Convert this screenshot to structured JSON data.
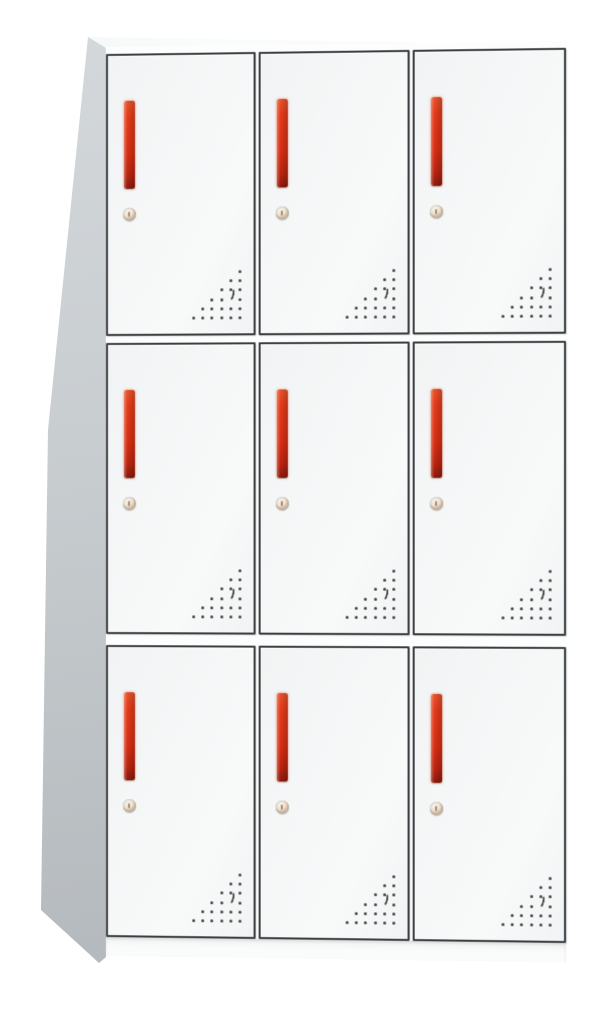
{
  "scene": {
    "description": "Product photo of a white nine-door steel locker cabinet, viewed from the front-left, with red vertical recessed handles, round cam locks and triangular ventilation-hole patterns on each door",
    "background": "#ffffff"
  },
  "cabinet": {
    "type": "nine-door-locker",
    "grid": {
      "rows": 3,
      "cols": 3,
      "door_count": 9
    },
    "doors": [
      {
        "id": "door-1",
        "row": 1,
        "col": 1
      },
      {
        "id": "door-2",
        "row": 1,
        "col": 2
      },
      {
        "id": "door-3",
        "row": 1,
        "col": 3
      },
      {
        "id": "door-4",
        "row": 2,
        "col": 1
      },
      {
        "id": "door-5",
        "row": 2,
        "col": 2
      },
      {
        "id": "door-6",
        "row": 2,
        "col": 3
      },
      {
        "id": "door-7",
        "row": 3,
        "col": 1
      },
      {
        "id": "door-8",
        "row": 3,
        "col": 2
      },
      {
        "id": "door-9",
        "row": 3,
        "col": 3
      }
    ],
    "door_features": [
      "vertical-handle",
      "cam-lock",
      "vent-holes"
    ],
    "vent_pattern": {
      "shape": "right-triangle-bottom-right",
      "rows": 6,
      "dot_spacing_px": 9.2,
      "dot_size_px": 3,
      "omitted_dots": [
        [
          3,
          1
        ]
      ],
      "has_crescent_cutout": true
    }
  },
  "colors": {
    "bg": "#ffffff",
    "body": "#fcfdfd",
    "door_face": "#f1f3f4",
    "door_face_light": "#f8fafa",
    "frame": "#3b3f42",
    "side_light": "#d5d9dc",
    "side_mid": "#c7cccf",
    "side_dark": "#b0b5b9",
    "handle_top": "#e8542c",
    "handle_core": "#e63c1a",
    "handle_mid": "#d92f14",
    "handle_dark": "#bb2410",
    "handle_deep": "#8c1a0c",
    "lock_ring": "#b9bdbf",
    "lock_face": "#f7f3ec",
    "lock_tan": "#d8b58f",
    "vent_dot": "#454545"
  }
}
